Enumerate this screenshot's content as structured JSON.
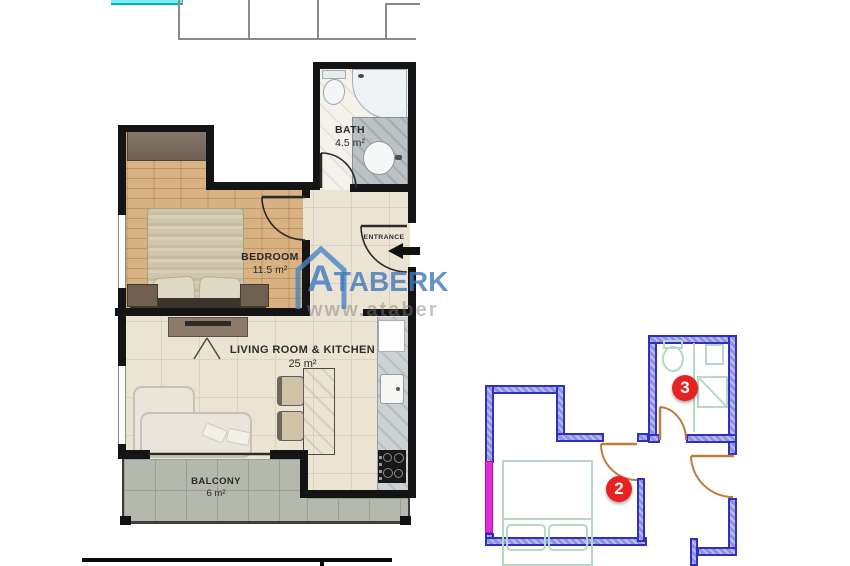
{
  "floorplan": {
    "rooms": {
      "bath": {
        "label": "BATH",
        "area": "4.5 m²"
      },
      "bedroom": {
        "label": "BEDROOM",
        "area": "11.5 m²"
      },
      "living": {
        "label": "LIVING ROOM & KITCHEN",
        "area": "25 m²"
      },
      "balcony": {
        "label": "BALCONY",
        "area": "6 m²"
      }
    },
    "entrance_label": "ENTRANCE"
  },
  "watermark": {
    "brand_first": "A",
    "brand_rest": "TABERK",
    "url_text": "www.ataberk"
  },
  "site_plan": {
    "badge_2": "2",
    "badge_3": "3"
  },
  "colors": {
    "wall_black": "#141414",
    "site_wall_fill": "#8f92e0",
    "site_wall_stroke": "#3030c0",
    "door_orange": "#c07c3c",
    "window_marker_magenta": "#e82ad8",
    "badge_red": "#e62222",
    "watermark_blue": "#427ac0",
    "pool_cyan": "#7deef0",
    "wood_floor": "#d9b283",
    "balcony_tile": "#b5b8ac"
  }
}
